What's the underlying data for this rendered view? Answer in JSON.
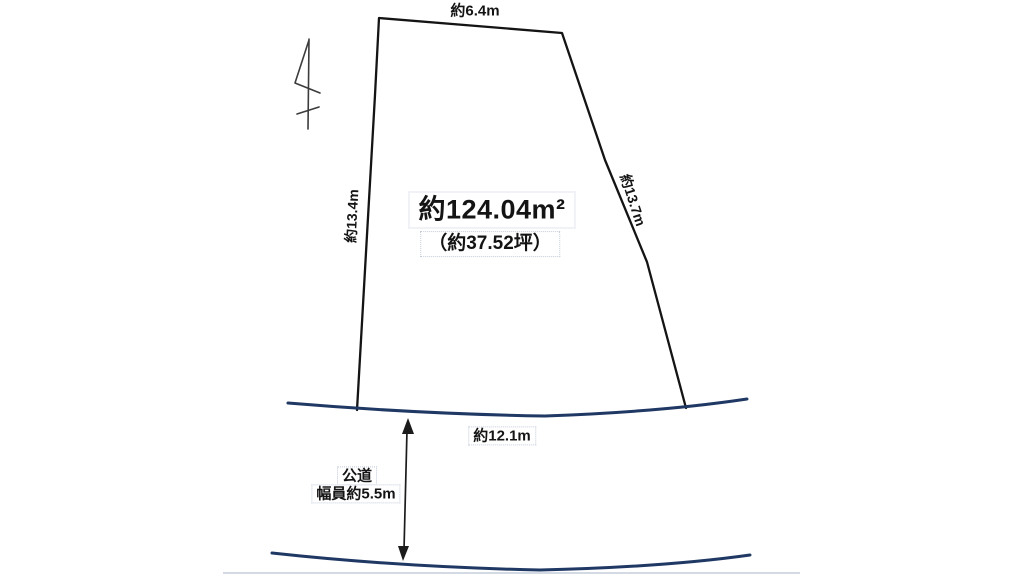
{
  "colors": {
    "background": "#ffffff",
    "parcel_line": "#141414",
    "road_line": "#1f3864",
    "arrow": "#1c1c1c",
    "compass": "#3c3c3c",
    "dotted_box_border": "#c3cbd9",
    "faint_edge_line": "#d4dae4",
    "text": "#141414"
  },
  "plot": {
    "area_label": "約124.04m²",
    "area_tsubo_label": "（約37.52坪）",
    "edge_top_label": "約6.4m",
    "edge_left_label": "約13.4m",
    "edge_right_label": "約13.7m",
    "frontage_label": "約12.1m"
  },
  "road": {
    "name_label": "公道",
    "width_label": "幅員約5.5m"
  },
  "measurements": {
    "area_m2": 124.04,
    "area_tsubo": 37.52,
    "edge_top_m": 6.4,
    "edge_left_m": 13.4,
    "edge_right_m": 13.7,
    "frontage_m": 12.1,
    "road_width_m": 5.5
  },
  "icons": {
    "north_mark": "hand-drawn-north-arrow"
  }
}
